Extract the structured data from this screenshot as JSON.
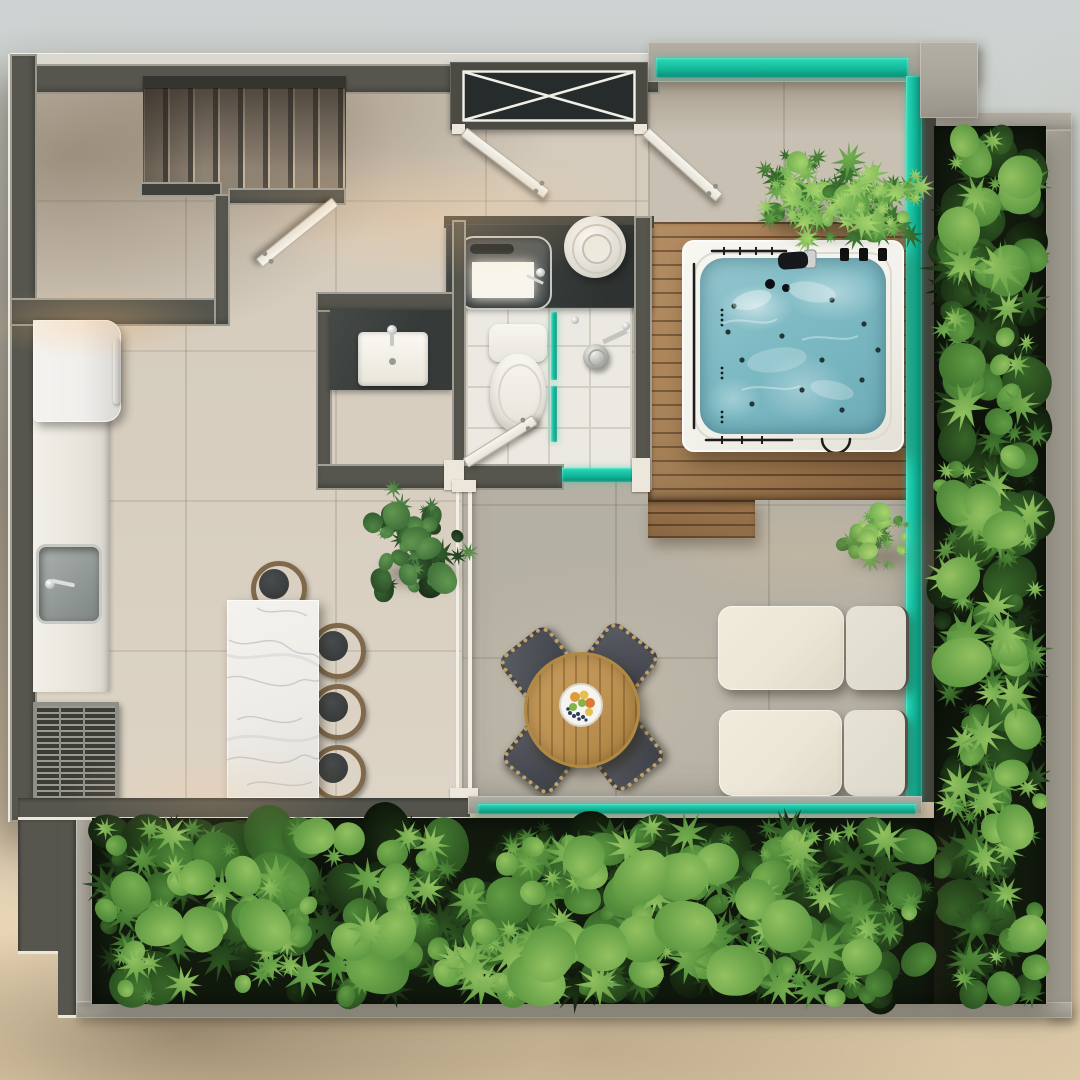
{
  "scene": {
    "type": "architectural floor plan render",
    "view": "top-down",
    "description": "Photorealistic top-view render of a penthouse level: staircase, bathroom, kitchen with marble island, round dining table, two lounge sofas, wooden deck with jacuzzi, glass railings and vertical garden hedges"
  },
  "palette": {
    "bg-top": "#cdd3d2",
    "bg-mid": "#d7d2c6",
    "bg-bottom": "#e8d5b6",
    "wall": "#56564e",
    "wall-dark": "#3e3e37",
    "trim": "#ece7da",
    "floor-a": "#d8cfc1",
    "floor-living": "#b5b0a4",
    "floor-top": "#c8c0b2",
    "tile-white": "#ebe9e1",
    "tile-line": "#d2cfc5",
    "glass": "#12b89a",
    "glass-deep": "#0a8a74",
    "concrete": "#a8a49a",
    "concrete-dark": "#8f8b81",
    "wood-1": "#a47c50",
    "wood-2": "#6f5335",
    "table-wood": "#bd9252",
    "water": "#7cb9c3",
    "tub": "#f3f1eb",
    "marble": "#eeece7",
    "marble-vein": "#aeaeb4",
    "sofa-1": "#ece6d7",
    "sofa-2": "#ddd9cc",
    "cushion": "#494c52",
    "fringe": "#c3a267",
    "seat": "#393c3c",
    "bronze": "#80694a",
    "chrome": "#d3d4d2",
    "fixture": "#f5f3ed",
    "counter-dark": "#383d3b",
    "fridge": "#f0efec",
    "hedge-base": "#121a0e",
    "fruit-0": "#dd9a3e",
    "fruit-1": "#e5c04c",
    "fruit-2": "#83b44b",
    "fruit-3": "#2e3d5e",
    "fruit-4": "#d97b35"
  },
  "foliage": {
    "leaf_hedge": [
      "#0e180a",
      "#152510",
      "#1c3315",
      "#24431b",
      "#2d5522",
      "#376628",
      "#427830",
      "#508a3a",
      "#619c44",
      "#77af50",
      "#92c160"
    ],
    "leaf_fern": [
      "#2d5a26",
      "#37692c",
      "#427a33",
      "#4f8c3c",
      "#5f9e46",
      "#73b152",
      "#8cc35f",
      "#a8d46e"
    ],
    "leaf_plant": [
      "#1b3019",
      "#234020",
      "#2c5028",
      "#366131",
      "#42733b",
      "#508545",
      "#619750"
    ]
  },
  "legend": [
    {
      "name": "staircase",
      "kind": "stairs descending along top-left wall"
    },
    {
      "name": "closet-x",
      "kind": "built-in wardrobe drawn with X cross"
    },
    {
      "name": "swing-doors",
      "kind": "four white swing door leaves"
    },
    {
      "name": "rooftop-terrace",
      "kind": "open terrace with glass railing"
    },
    {
      "name": "jacuzzi",
      "kind": "white hot tub with teal water on wood deck"
    },
    {
      "name": "wood-deck",
      "kind": "hardwood plank deck with lower step"
    },
    {
      "name": "vertical-garden",
      "kind": "dense green hedge planters on right and bottom"
    },
    {
      "name": "fern-planters",
      "kind": "fern clumps on terrace and deck"
    },
    {
      "name": "bathroom-vanity",
      "kind": "dark stone counter with vessel sink"
    },
    {
      "name": "powder-sink",
      "kind": "white rectangular sink on dark counter"
    },
    {
      "name": "toilet",
      "kind": "white toilet in tiled room"
    },
    {
      "name": "shower",
      "kind": "glass partition with round shower head"
    },
    {
      "name": "refrigerator",
      "kind": "white fridge"
    },
    {
      "name": "kitchen-counter",
      "kind": "white counter with steel sink"
    },
    {
      "name": "grill-vent",
      "kind": "stainless grate"
    },
    {
      "name": "marble-island",
      "kind": "white marble island with four stools"
    },
    {
      "name": "dining-table",
      "kind": "round wood table with fruit plate and four chairs"
    },
    {
      "name": "outdoor-sofas",
      "kind": "two cream lounge sofas"
    },
    {
      "name": "potted-plant",
      "kind": "green plant by bathroom wall"
    }
  ]
}
